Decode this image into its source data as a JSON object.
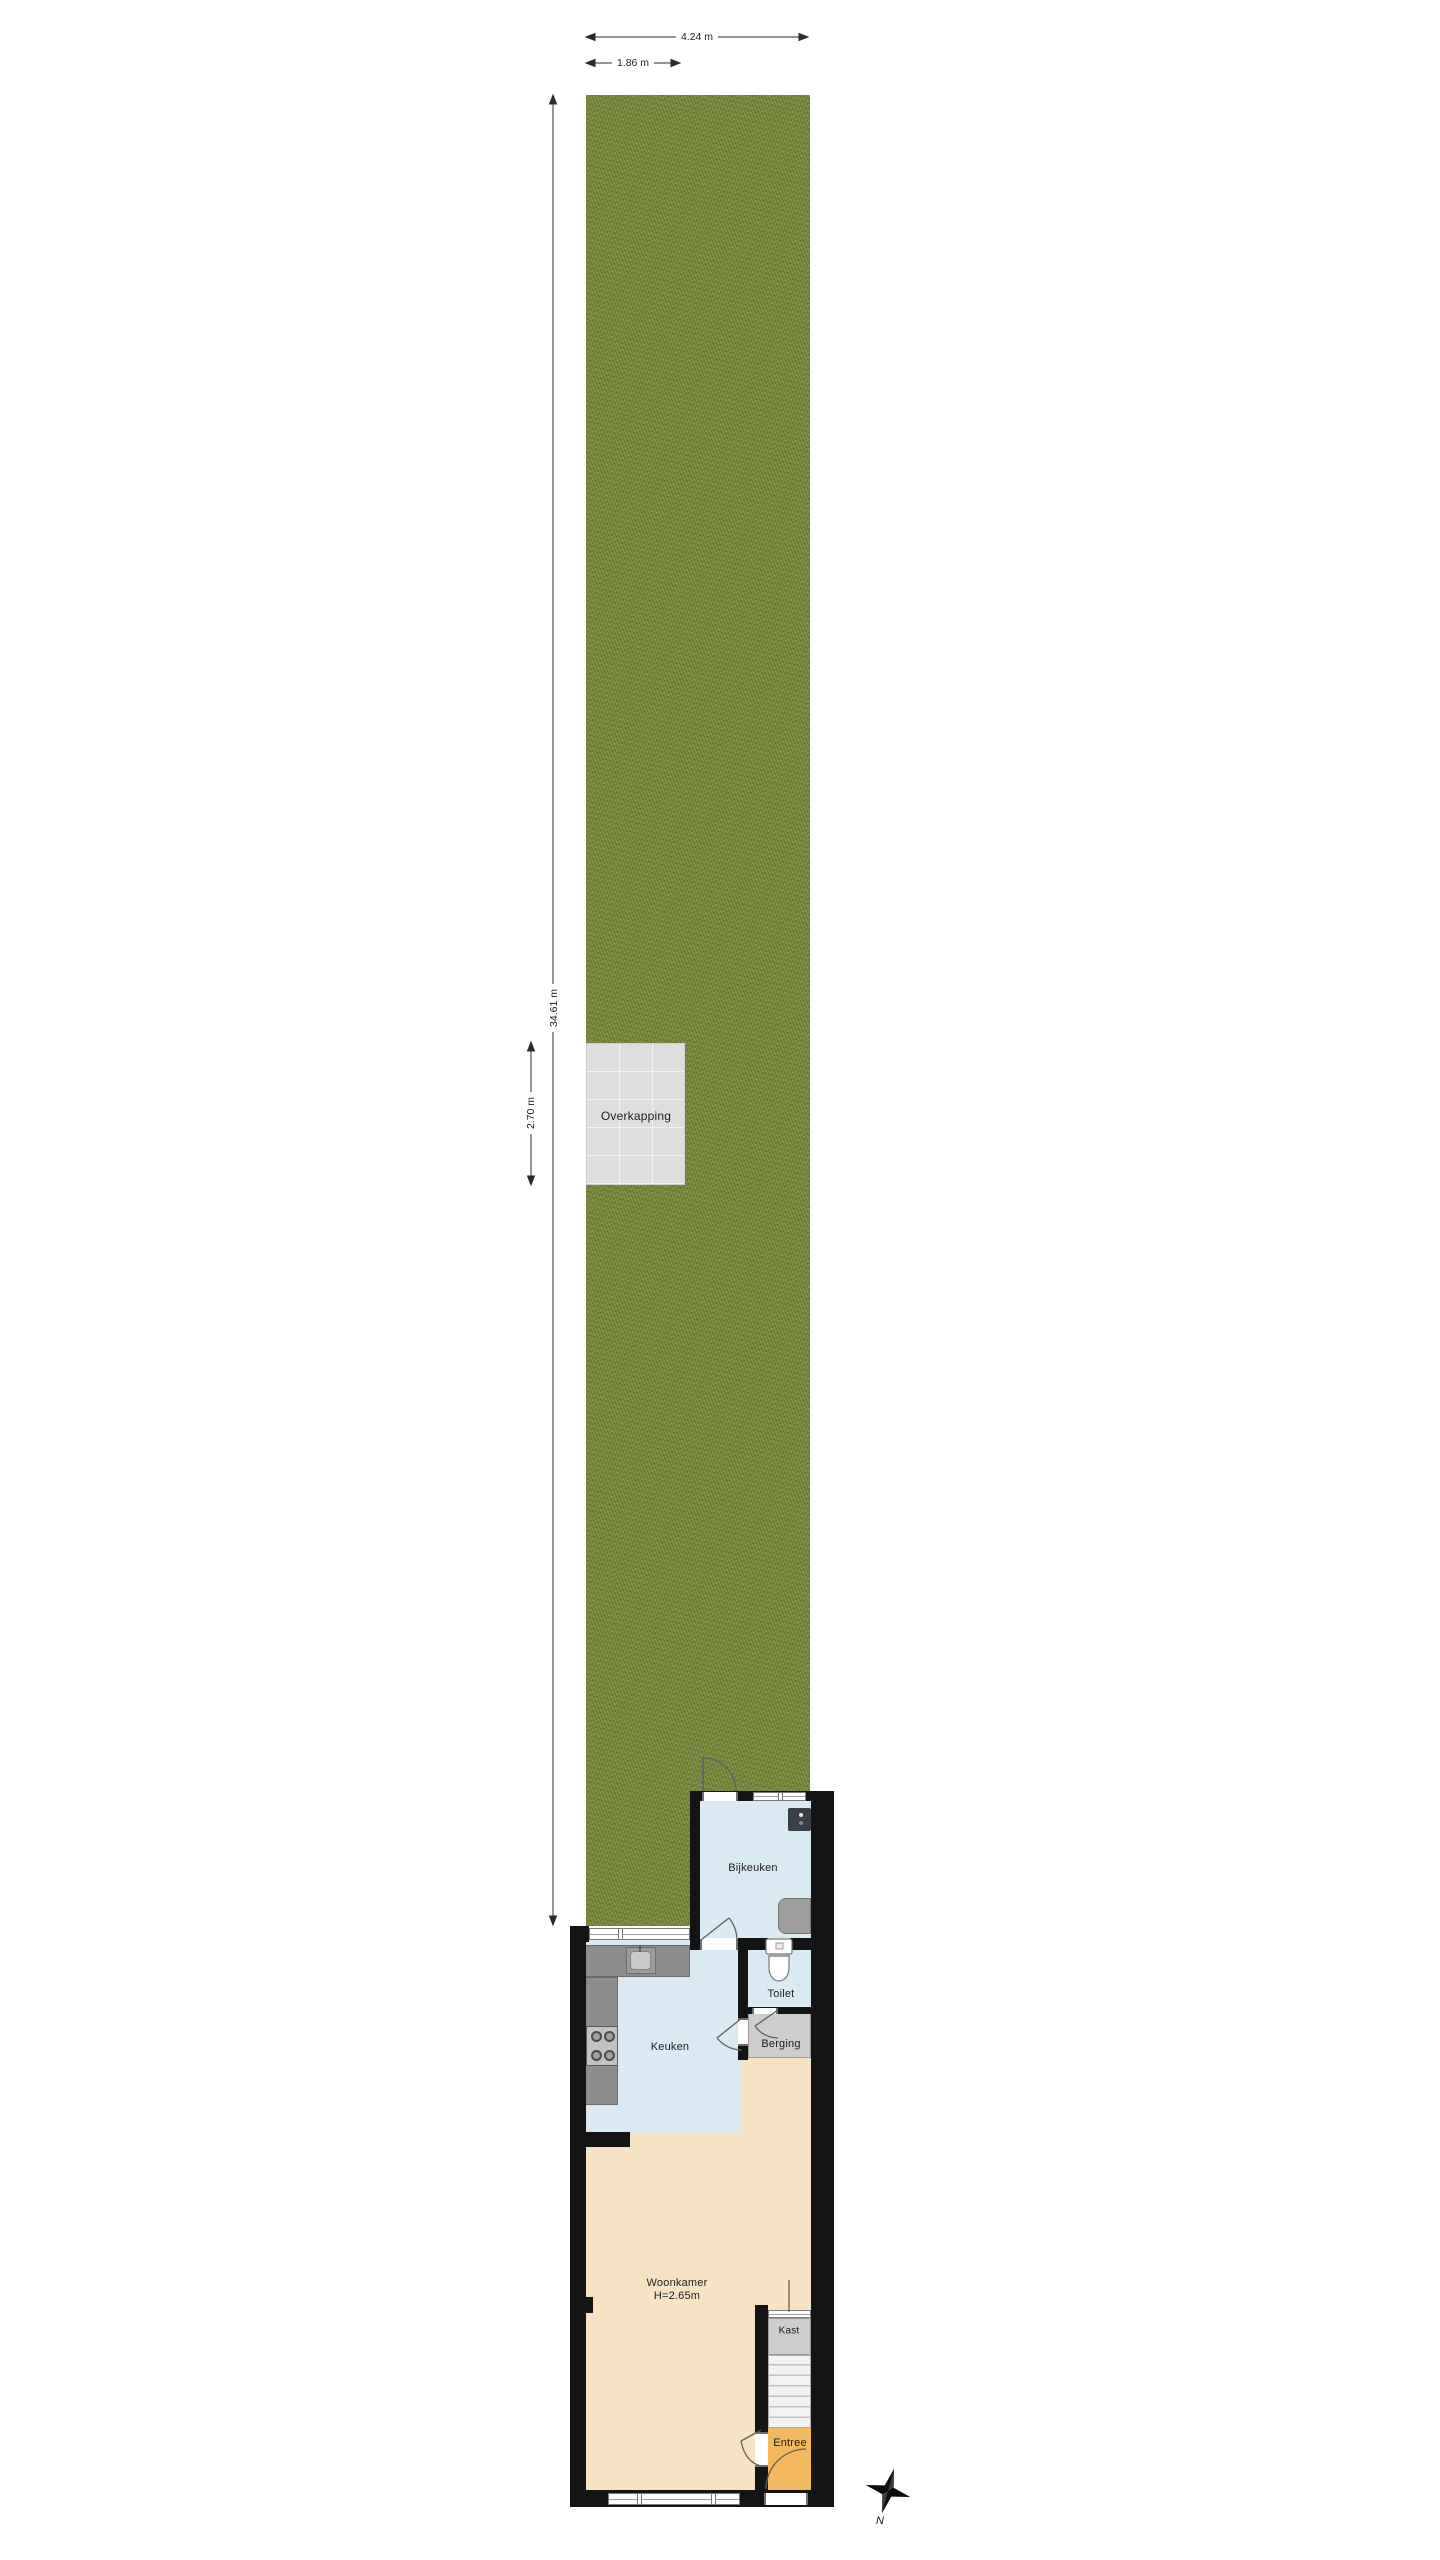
{
  "plan": {
    "dimensions": {
      "plot_width": "4.24 m",
      "overkapping_width": "1.86 m",
      "plot_depth": "34.61 m",
      "overkapping_depth": "2.70 m"
    },
    "rooms": {
      "overkapping": "Overkapping",
      "bijkeuken": "Bijkeuken",
      "toilet": "Toilet",
      "keuken": "Keuken",
      "berging": "Berging",
      "woonkamer": "Woonkamer",
      "woonkamer_ceiling": "H=2.65m",
      "kast": "Kast",
      "entree": "Entree"
    },
    "compass": {
      "north": "N"
    },
    "colors": {
      "grass": "#7d8e44",
      "room_blue": "#d9eaf2",
      "room_peach": "#f7e3c4",
      "room_orange": "#f2b95e",
      "room_gray": "#cdcdcd",
      "wall": "#141414"
    }
  }
}
